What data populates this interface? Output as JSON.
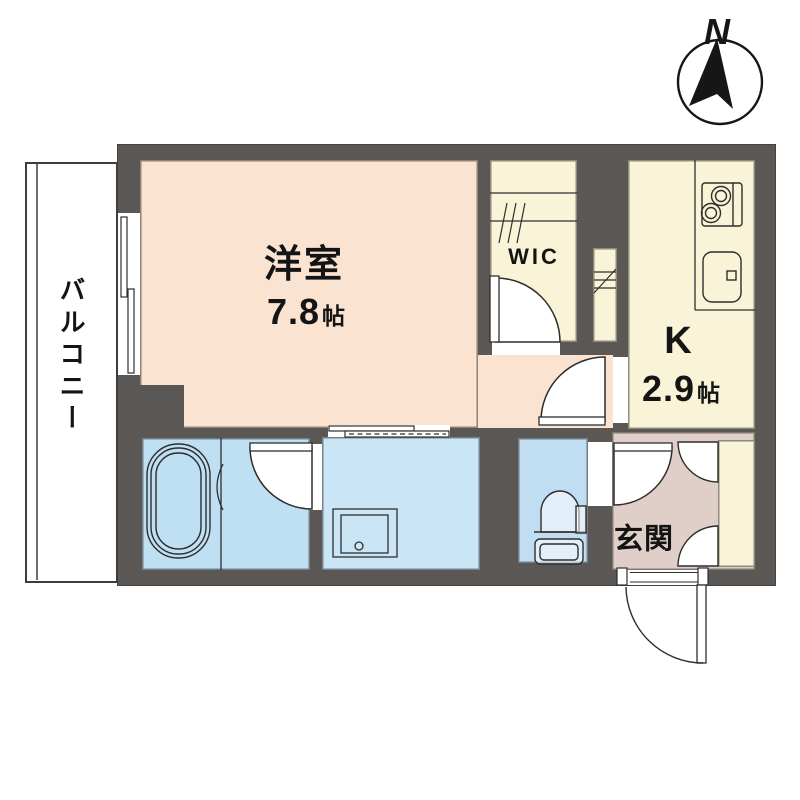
{
  "compass": {
    "label": "N"
  },
  "rooms": {
    "balcony": {
      "label": "バルコニー"
    },
    "living": {
      "label": "洋室",
      "size_value": "7.8",
      "size_unit": "帖"
    },
    "wic": {
      "label": "WIC"
    },
    "kitchen": {
      "label": "K",
      "size_value": "2.9",
      "size_unit": "帖"
    },
    "entrance": {
      "label": "玄関"
    }
  },
  "colors": {
    "wall": "#5a5755",
    "line": "#2e2e2e",
    "text": "#141414",
    "room-living": "#fbe3d2",
    "room-closet": "#f9f4d7",
    "room-bath": "#bfdff2",
    "room-wash": "#cae5f6",
    "room-toilet": "#c0ddf1",
    "room-entrance": "#e0cfc9",
    "balcony": "#ffffff"
  }
}
